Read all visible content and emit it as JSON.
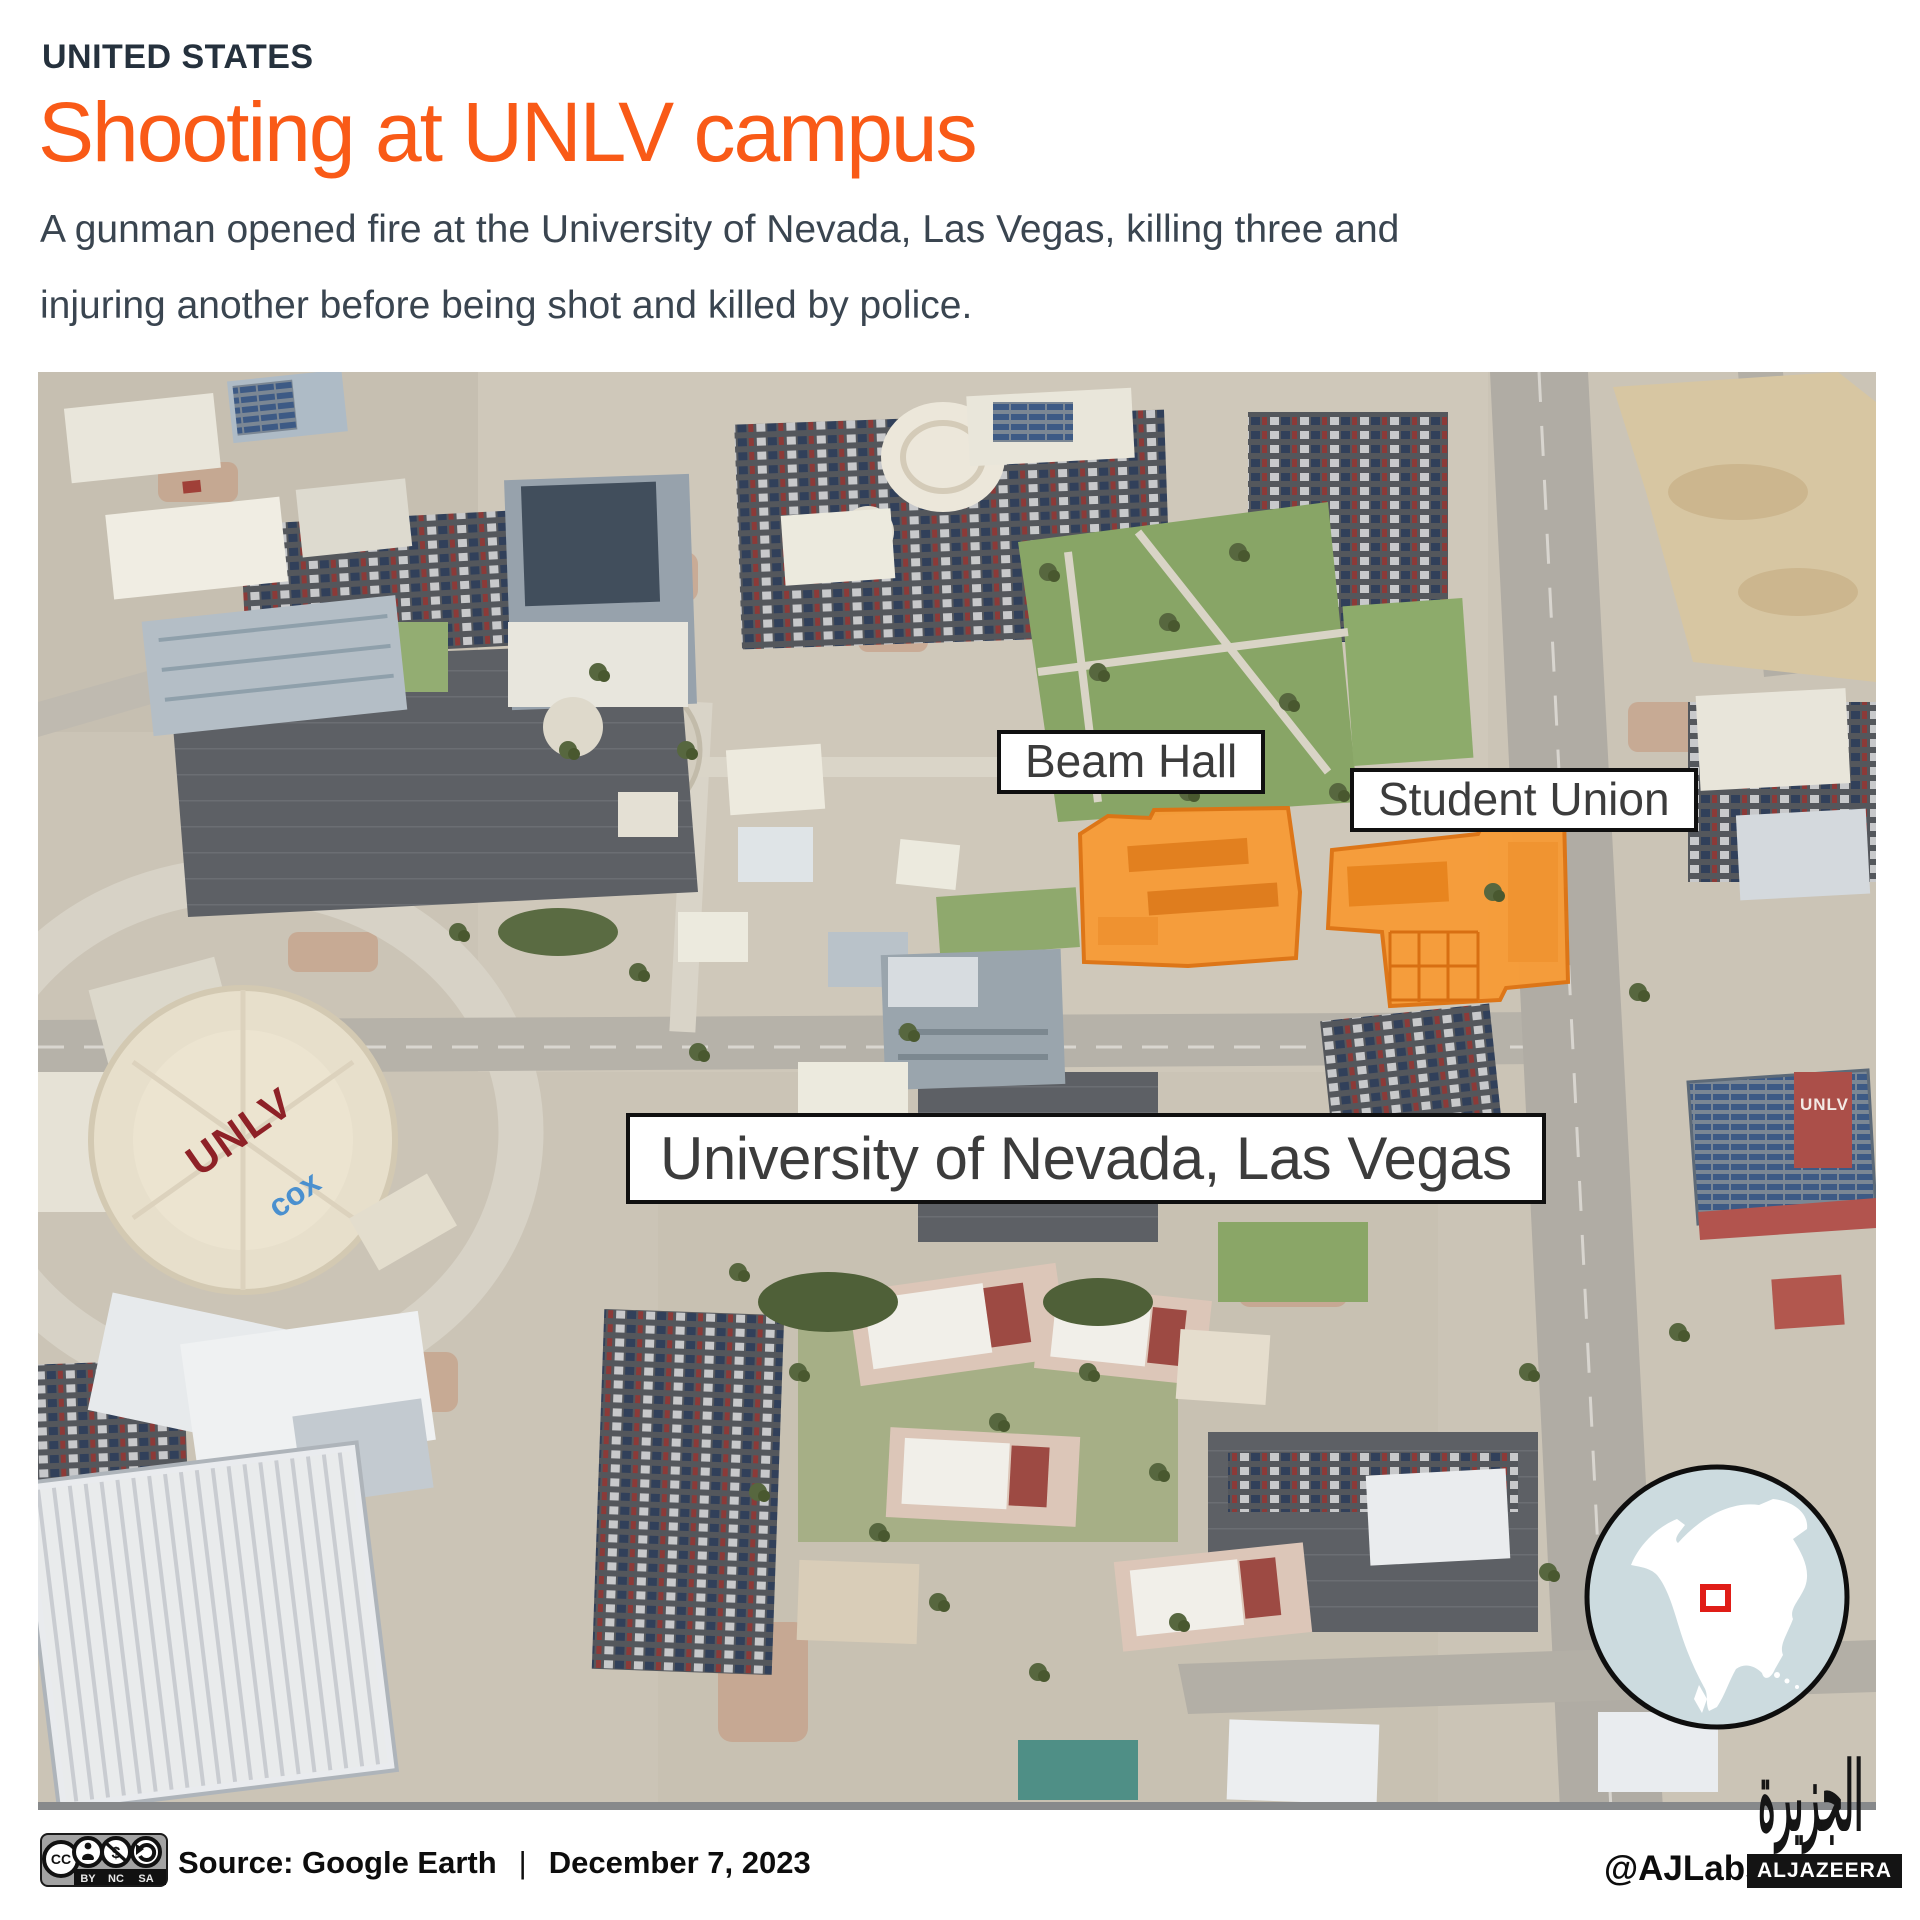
{
  "header": {
    "eyebrow": "UNITED STATES",
    "title": "Shooting at UNLV campus",
    "subtitle": "A gunman opened fire at the University of Nevada, Las Vegas, killing three and injuring another before being shot and killed by police."
  },
  "map": {
    "labels": {
      "beam_hall": "Beam Hall",
      "student_union": "Student Union",
      "university": "University of Nevada, Las Vegas"
    },
    "stadium": {
      "roof_text_unlv": "UNLV",
      "roof_text_cox": "cox"
    },
    "garage_text": "UNLV",
    "highlight_color": "#F79C38",
    "highlight_stroke": "#DE7413"
  },
  "inset": {
    "water_color": "#CCDBDF",
    "land_color": "#FFFFFF",
    "marker_color": "#E01D17"
  },
  "footer": {
    "license": {
      "cc": "CC",
      "by": "BY",
      "nc": "NC",
      "sa": "SA"
    },
    "source_label": "Source: Google Earth",
    "separator": "|",
    "date": "December 7, 2023",
    "credit": "@AJLabs",
    "brand": "ALJAZEERA",
    "brand_arabic": "الجزيرة"
  },
  "icons": {
    "cc": "cc-circle",
    "by": "person-attribution",
    "nc": "no-dollar",
    "sa": "share-alike-arrow"
  }
}
